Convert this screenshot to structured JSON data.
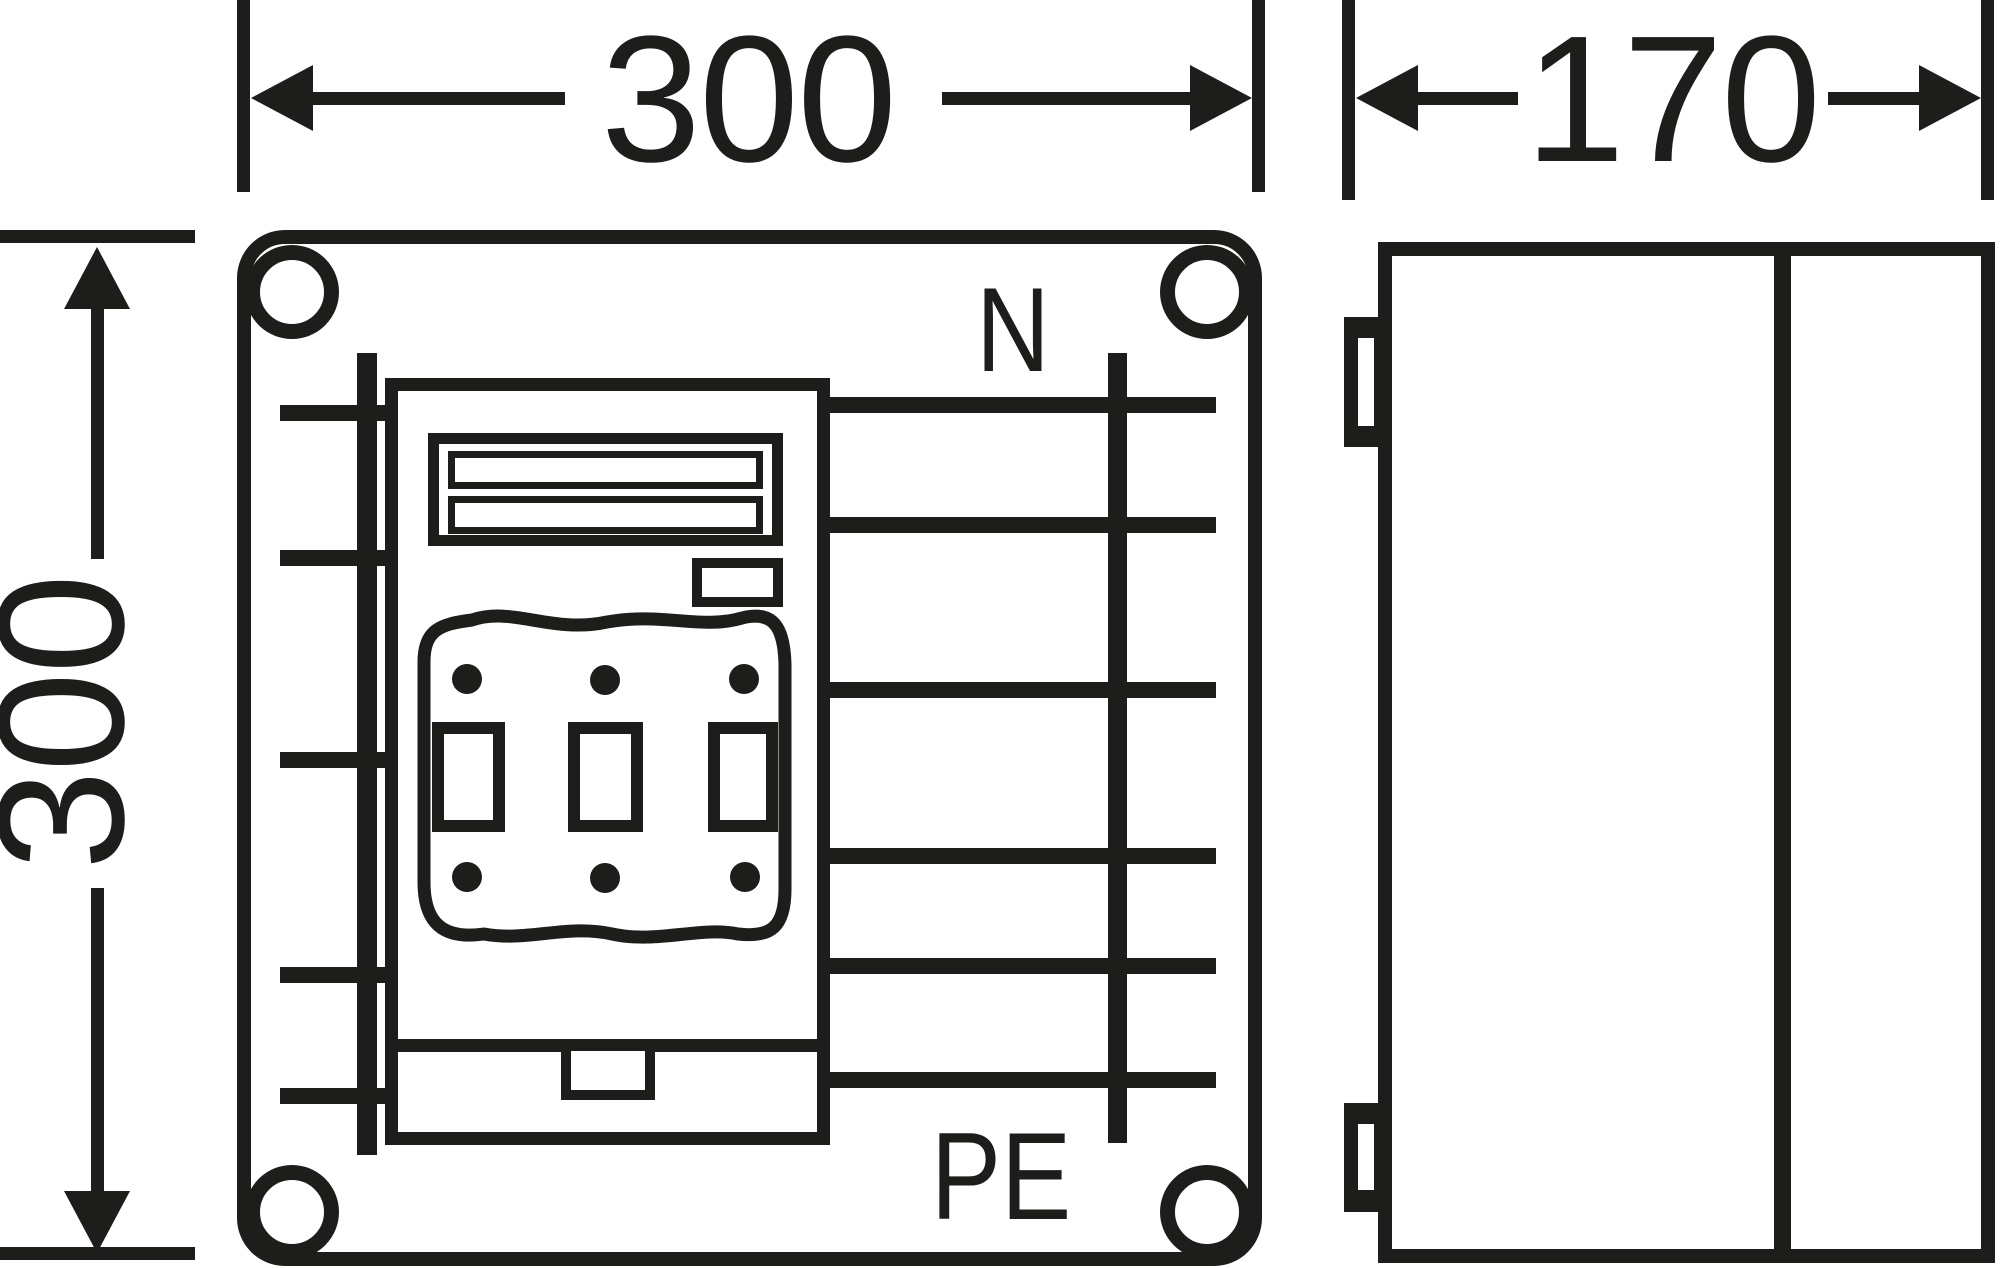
{
  "drawing_title": "enclosure-dimension-drawing",
  "colors": {
    "ink": "#1d1d1b",
    "paper": "#ffffff"
  },
  "front_view": {
    "width_label": "300",
    "height_label": "300",
    "neutral_label": "N",
    "earth_label": "PE"
  },
  "side_view": {
    "depth_label": "170"
  }
}
